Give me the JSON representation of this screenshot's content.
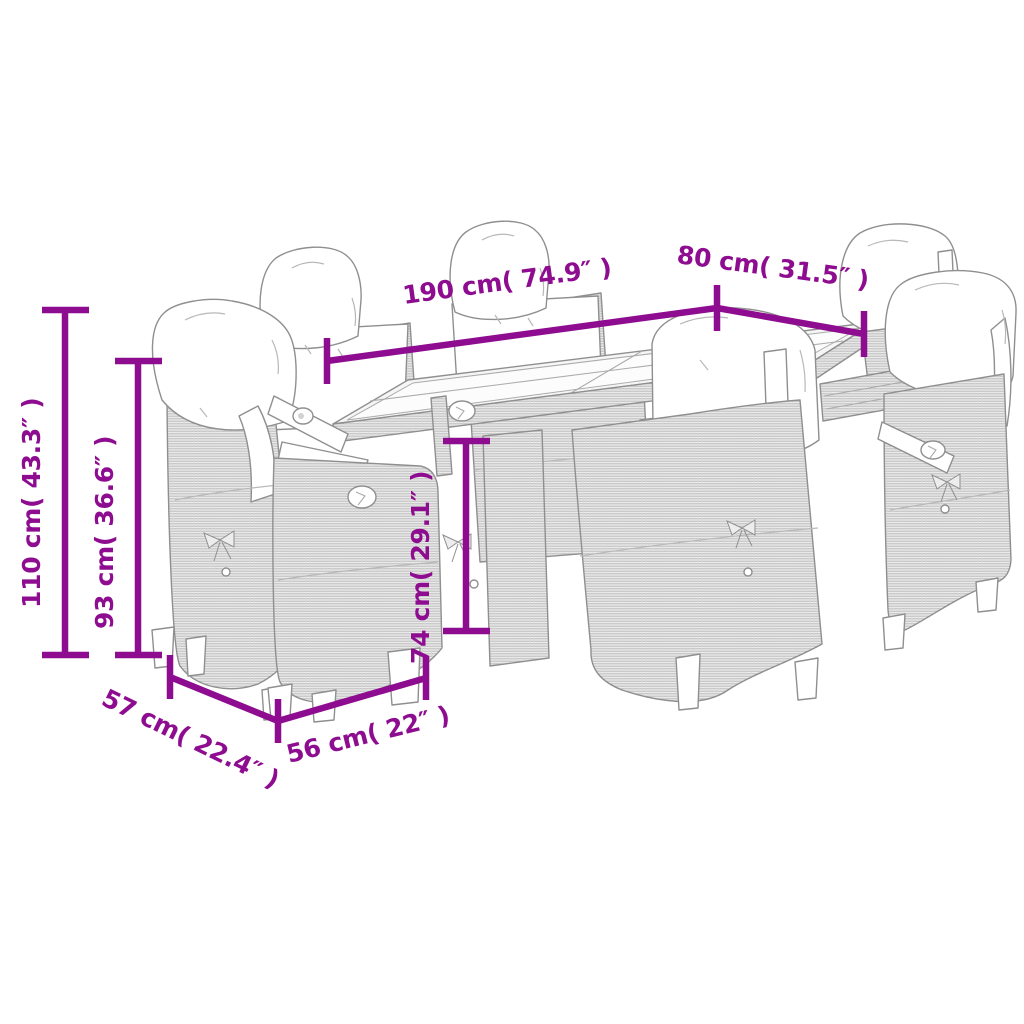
{
  "colors": {
    "accent": "#8E0C90",
    "line_art": "#8F8F8F",
    "background": "#FFFFFF"
  },
  "diagram": {
    "kind": "furniture-dimension-diagram",
    "depicts": "garden dining table with six cushioned wicker chairs",
    "labels": {
      "dim_190": "190 cm( 74.9″ )",
      "dim_80": "80 cm( 31.5″ )",
      "dim_110": "110 cm( 43.3″ )",
      "dim_93": "93 cm( 36.6″ )",
      "dim_74": "74 cm( 29.1″ )",
      "dim_57": "57 cm( 22.4″ )",
      "dim_56": "56 cm( 22″ )"
    }
  }
}
